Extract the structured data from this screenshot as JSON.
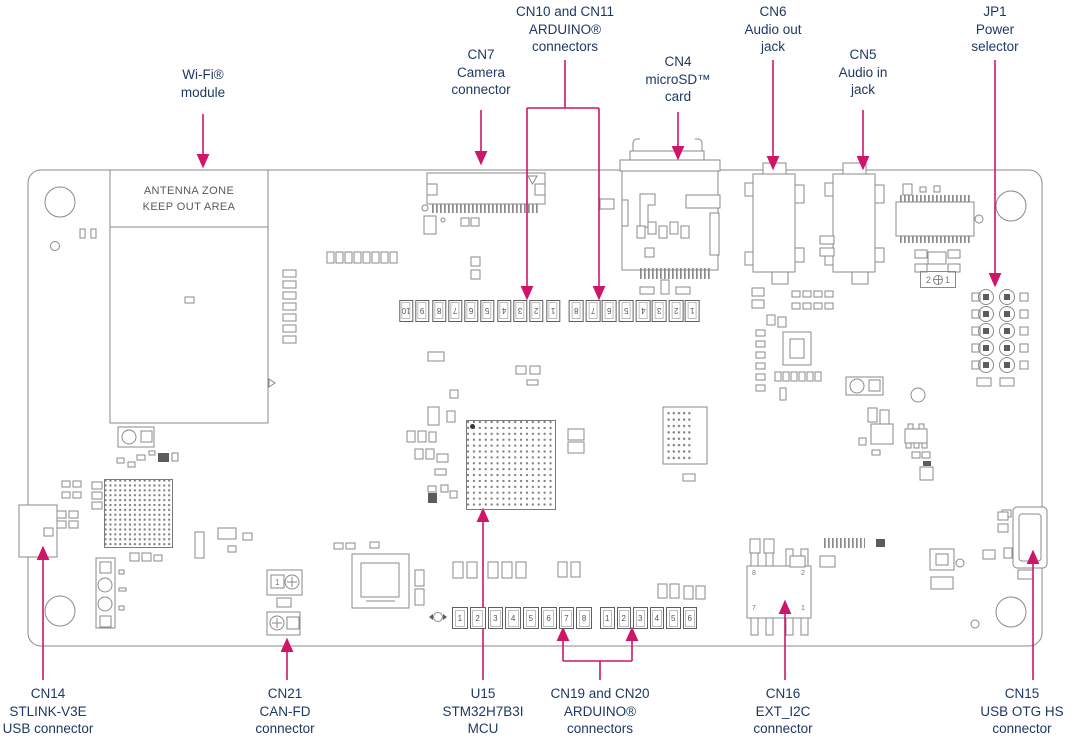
{
  "colors": {
    "label": "#1f3864",
    "arrow": "#ce1567",
    "board": "#8a8a8a",
    "silk": "#6e6e6e"
  },
  "callouts": {
    "wifi": {
      "lines": [
        "Wi-Fi®",
        "module"
      ]
    },
    "cn7": {
      "lines": [
        "CN7",
        "Camera",
        "connector"
      ]
    },
    "cn10_cn11": {
      "lines": [
        "CN10 and CN11",
        "ARDUINO®",
        "connectors"
      ]
    },
    "cn4": {
      "lines": [
        "CN4",
        "microSD™",
        "card"
      ]
    },
    "cn6": {
      "lines": [
        "CN6",
        "Audio out",
        "jack"
      ]
    },
    "cn5": {
      "lines": [
        "CN5",
        "Audio in",
        "jack"
      ]
    },
    "jp1": {
      "lines": [
        "JP1",
        "Power",
        "selector"
      ]
    },
    "cn14": {
      "lines": [
        "CN14",
        "STLINK-V3E",
        "USB connector"
      ]
    },
    "cn21": {
      "lines": [
        "CN21",
        "CAN-FD",
        "connector"
      ]
    },
    "u15": {
      "lines": [
        "U15",
        "STM32H7B3I",
        "MCU"
      ]
    },
    "cn19_cn20": {
      "lines": [
        "CN19 and CN20",
        "ARDUINO®",
        "connectors"
      ]
    },
    "cn16": {
      "lines": [
        "CN16",
        "EXT_I2C",
        "connector"
      ]
    },
    "cn15": {
      "lines": [
        "CN15",
        "USB OTG HS",
        "connector"
      ]
    }
  },
  "board": {
    "antenna_zone": [
      "ANTENNA ZONE",
      "KEEP OUT AREA"
    ],
    "jp1_silk": {
      "left": "2",
      "right": "1"
    },
    "cn16_pin_labels": [
      "8",
      "2",
      "7",
      "1"
    ],
    "cn21_pin1": "1",
    "pins": {
      "cn10": [
        "10",
        "9",
        "8",
        "7",
        "6",
        "5",
        "4",
        "3",
        "2",
        "1"
      ],
      "cn11": [
        "8",
        "7",
        "6",
        "5",
        "4",
        "3",
        "2",
        "1"
      ],
      "cn19": [
        "1",
        "2",
        "3",
        "4",
        "5",
        "6",
        "7",
        "8"
      ],
      "cn20": [
        "1",
        "2",
        "3",
        "4",
        "5",
        "6"
      ]
    }
  }
}
